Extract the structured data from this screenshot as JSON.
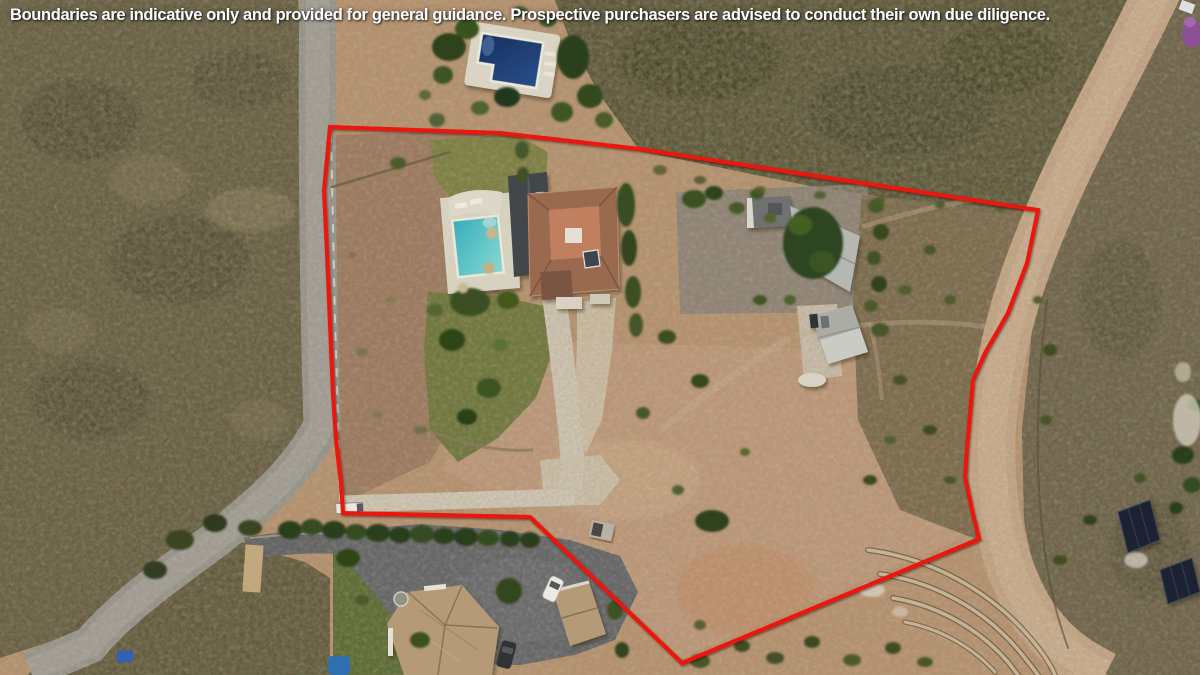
{
  "disclaimer": {
    "text": "Boundaries are indicative only and provided for general guidance. Prospective purchasers are advised to conduct their own due diligence.",
    "text_color": "#ffffff"
  },
  "boundary": {
    "color": "#ec1309",
    "stroke_width": 4,
    "points": [
      [
        330,
        127
      ],
      [
        500,
        133
      ],
      [
        640,
        149
      ],
      [
        1038,
        210
      ],
      [
        1027,
        263
      ],
      [
        1008,
        313
      ],
      [
        985,
        353
      ],
      [
        973,
        380
      ],
      [
        967,
        447
      ],
      [
        965,
        477
      ],
      [
        972,
        510
      ],
      [
        979,
        539
      ],
      [
        682,
        663
      ],
      [
        530,
        517
      ],
      [
        343,
        513
      ],
      [
        341,
        483
      ],
      [
        336,
        440
      ],
      [
        333,
        395
      ],
      [
        327,
        253
      ],
      [
        324,
        190
      ]
    ]
  },
  "scene": {
    "description": "aerial drone photo of a rural property for sale",
    "features": [
      {
        "name": "upper-swimming-pool",
        "color": "#1e3e75"
      },
      {
        "name": "main-villa-terracotta-roof",
        "color": "#9a6a50"
      },
      {
        "name": "villa-swimming-pool",
        "color": "#45b4be"
      },
      {
        "name": "outbuilding-roofs",
        "color": "#b4b7b2"
      },
      {
        "name": "solar-panel-arrays",
        "color": "#1c2430"
      },
      {
        "name": "neighbour-villa-roof",
        "color": "#b59a78"
      },
      {
        "name": "tarmac-lane",
        "color": "#96948c"
      },
      {
        "name": "asphalt-drive",
        "color": "#636569"
      },
      {
        "name": "dirt-track",
        "color": "#c3a585"
      },
      {
        "name": "stone-terrace-walls",
        "color": "#c6b394"
      }
    ]
  }
}
